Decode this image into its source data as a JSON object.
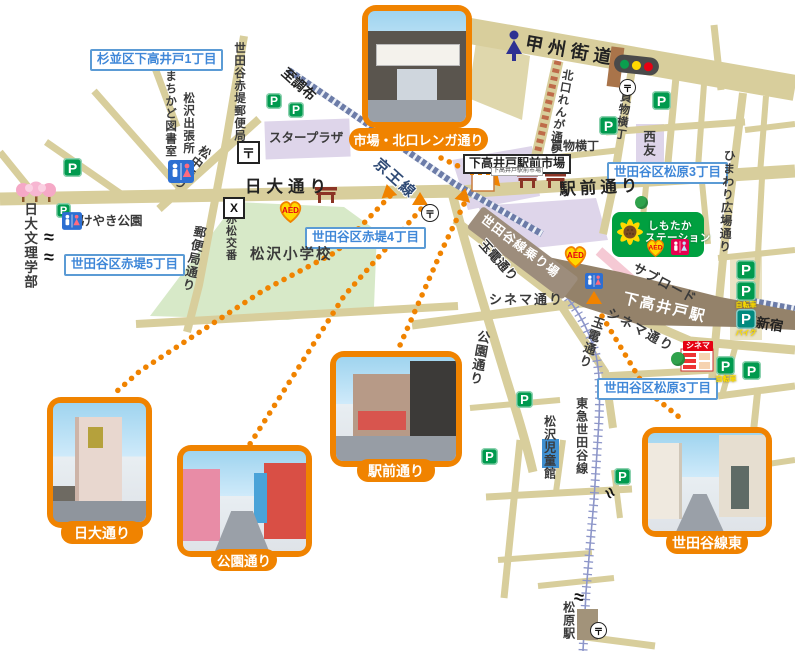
{
  "districts": {
    "suginami_shimotakaido1": "杉並区下高井戸1丁目",
    "akatsutsumi5": "世田谷区赤堤5丁目",
    "akatsutsumi4": "世田谷区赤堤4丁目",
    "matsubara3_north": "世田谷区松原3丁目",
    "matsubara3_south": "世田谷区松原3丁目"
  },
  "photos": {
    "market": {
      "label": "市場・北口レンガ通り"
    },
    "nichidai": {
      "label": "日大通り"
    },
    "koen": {
      "label": "公園通り"
    },
    "ekimae": {
      "label": "駅前通り"
    },
    "setagaya_east": {
      "label": "世田谷線東"
    }
  },
  "streets": {
    "koshu_kaido": "甲州街道",
    "nichidai_dori": "日大通り",
    "ekimae_dori": "駅前通り",
    "matsunaka_dori": "松中通り",
    "yubinkyoku_dori": "郵便局通り",
    "kitaguchi_renga_dori": "北口れんが通り",
    "kaimono_yokocho_v": "買物横丁",
    "kaimono_yokocho_h": "買物横丁",
    "himawari_hiroba_dori": "ひまわり広場通り",
    "cinema_dori_w": "シネマ通り",
    "cinema_dori_e": "シネマ通り",
    "tamaden_dori_n": "玉電通り",
    "tamaden_dori_s": "玉電通り",
    "koen_dori": "公園通り",
    "sub_road": "サブロード"
  },
  "rails": {
    "keio_line": "京王線",
    "tokyu_setagaya_line": "東急世田谷線",
    "to_chofu": "至調布",
    "to_shinjuku": "至新宿"
  },
  "stations": {
    "shimotakaido": "下高井戸駅",
    "matsubara": "松原駅",
    "setagaya_platform": "世田谷線乗り場"
  },
  "places": {
    "nichidai_bunri": "日大文理学部",
    "keyaki_park": "けやき公園",
    "machikado_library": "まちかど図書室",
    "matsuzawa_branch": "松沢出張所",
    "akatsutsumi_post_office": "世田谷赤堤郵便局",
    "akamatsu_koban": "赤松交番",
    "matsuzawa_elementary": "松沢小学校",
    "star_plaza": "スタープラザ",
    "seiyu": "西友",
    "ichiba_label": "下高井戸駅前市場",
    "ichiba_sign": "下高井戸駅前市場",
    "matsuzawa_jidokan": "松沢児童館",
    "shimotaka_station_line1": "しもたか",
    "shimotaka_station_line2": "ステーション",
    "cinema_sign": "シネマ"
  },
  "icons": {
    "parking": "P",
    "aed": "AED",
    "post": "〒",
    "koban": "X",
    "bicycle": "自転車",
    "bike": "バイク",
    "wave": "≈"
  },
  "colors": {
    "orange": "#F08300",
    "road_tan": "#D8CE9C",
    "school_green": "#D7E9C8",
    "building_purple": "#DED5EA",
    "label_blue": "#3F87D8",
    "parking_green": "#009A4E",
    "aed_yellow": "#FFD800",
    "keio_rail": "#6C7CA8",
    "setagaya_rail": "#8D96C9"
  }
}
